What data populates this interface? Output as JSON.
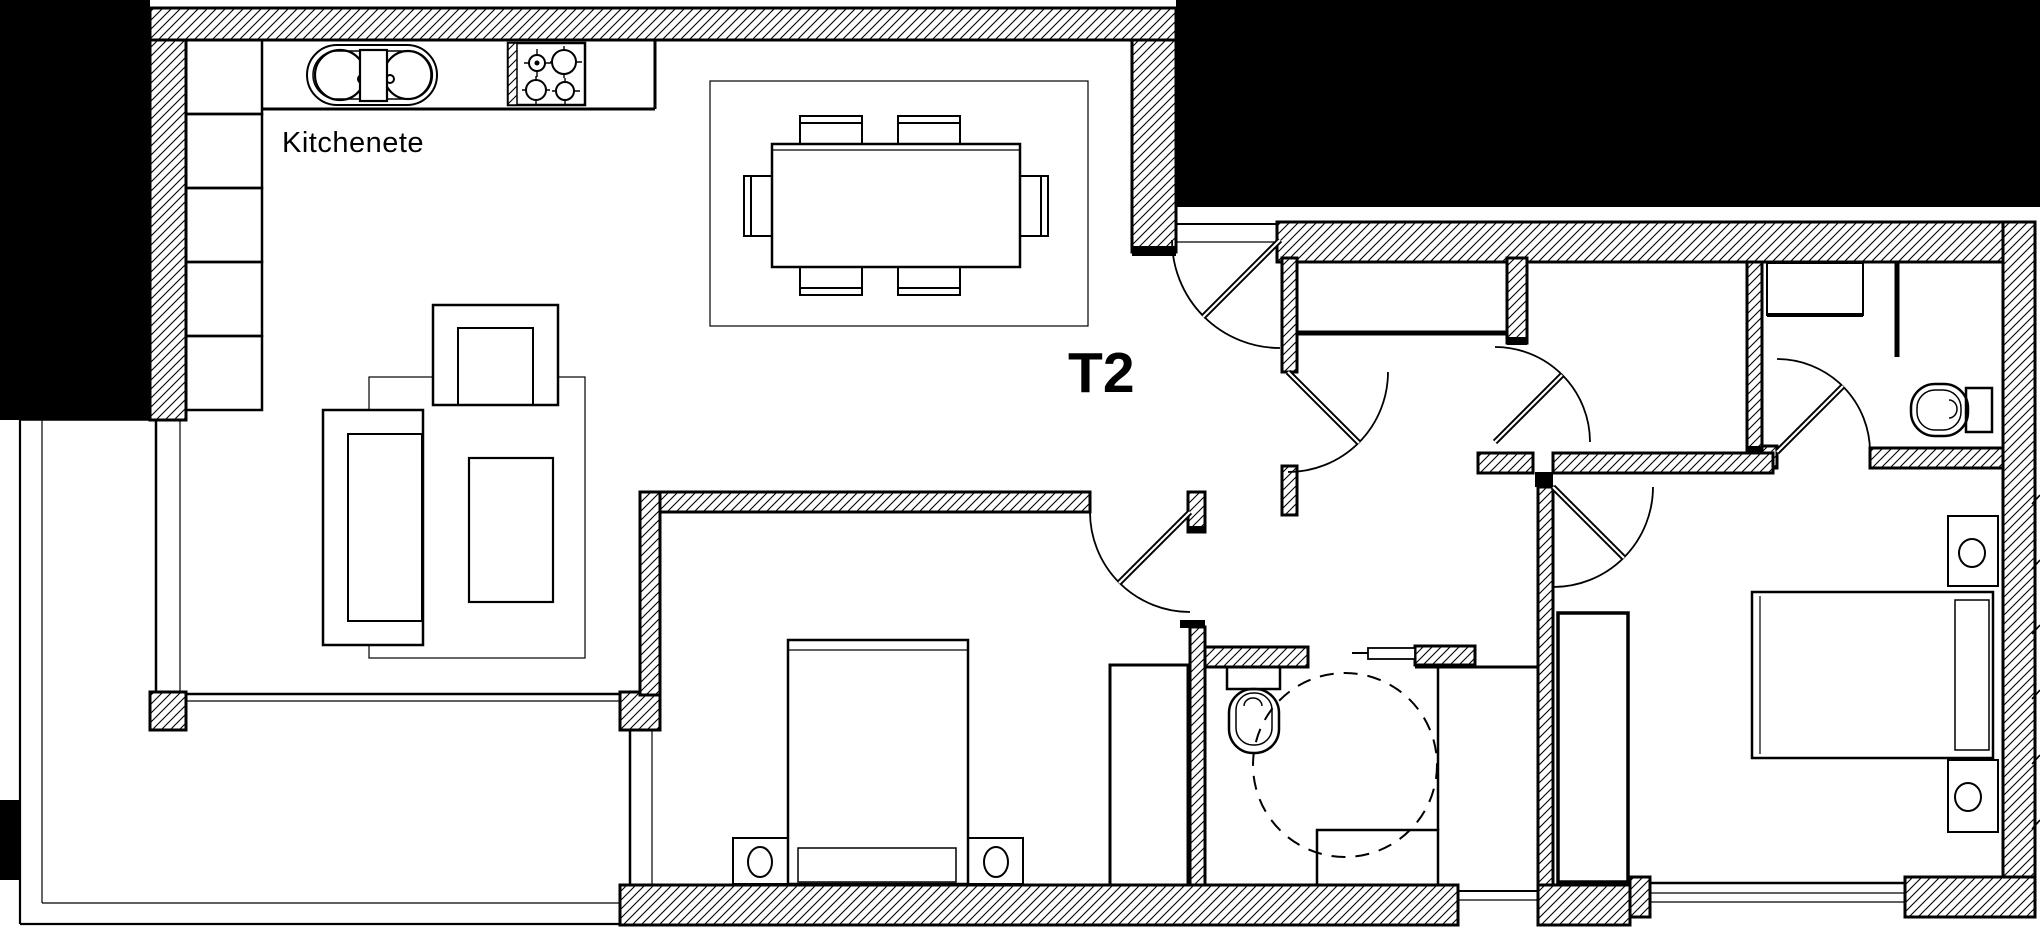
{
  "page": {
    "type": "architectural-floor-plan",
    "background_color": "#ffffff",
    "ink_color": "#000000"
  },
  "plan": {
    "unit_label": "T2",
    "labels": {
      "kitchenette": "Kitchenete"
    },
    "inventory": {
      "rooms": [
        "kitchenette-living-room",
        "dining-area",
        "entrance-hall",
        "storage-room",
        "bathroom-1",
        "bedroom-1",
        "bedroom-2",
        "ensuite-bathroom",
        "terrace"
      ],
      "fixtures": [
        "kitchen-double-sink",
        "cooktop-4-burners",
        "kitchen-cabinet-run",
        "dining-table-six-chairs",
        "sofa-set-with-rug",
        "double-bed-1",
        "double-bed-2",
        "nightstands-with-lamps",
        "wardrobe-bedroom-1",
        "wardrobe-bedroom-2",
        "toilet-bathroom-1",
        "toilet-ensuite",
        "shower-tray",
        "vanity-basin",
        "closet-shelf",
        "accessibility-turning-circle"
      ],
      "door_count": 6,
      "window_count": 5
    }
  }
}
